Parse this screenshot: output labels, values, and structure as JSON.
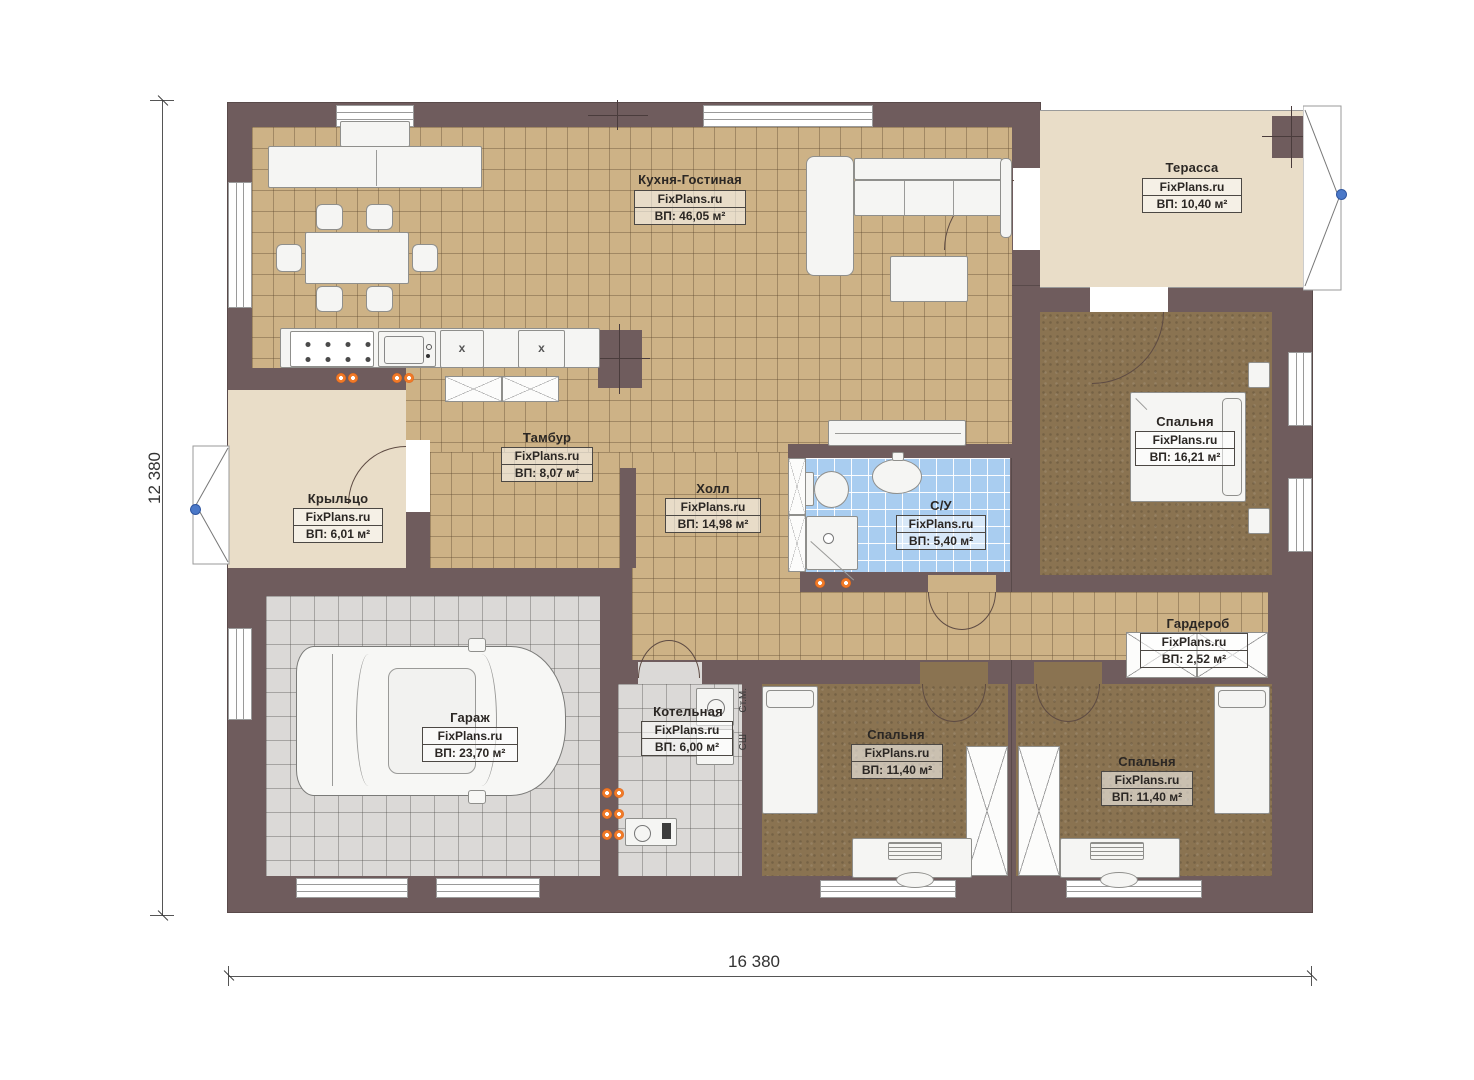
{
  "site_brand": "FixPlans.ru",
  "plan": {
    "dimensions": {
      "horizontal": "16 380",
      "vertical": "12 380"
    },
    "rooms": [
      {
        "id": "kitchen_living",
        "name": "Кухня-Гостиная",
        "brand": "FixPlans.ru",
        "area": "ВП: 46,05 м²"
      },
      {
        "id": "terrace",
        "name": "Терасса",
        "brand": "FixPlans.ru",
        "area": "ВП: 10,40 м²"
      },
      {
        "id": "bedroom_right",
        "name": "Спальня",
        "brand": "FixPlans.ru",
        "area": "ВП: 16,21 м²"
      },
      {
        "id": "tambour",
        "name": "Тамбур",
        "brand": "FixPlans.ru",
        "area": "ВП: 8,07 м²"
      },
      {
        "id": "hall",
        "name": "Холл",
        "brand": "FixPlans.ru",
        "area": "ВП: 14,98 м²"
      },
      {
        "id": "bathroom",
        "name": "С/У",
        "brand": "FixPlans.ru",
        "area": "ВП: 5,40 м²"
      },
      {
        "id": "porch",
        "name": "Крыльцо",
        "brand": "FixPlans.ru",
        "area": "ВП: 6,01 м²"
      },
      {
        "id": "wardrobe",
        "name": "Гардероб",
        "brand": "FixPlans.ru",
        "area": "ВП: 2,52 м²"
      },
      {
        "id": "garage",
        "name": "Гараж",
        "brand": "FixPlans.ru",
        "area": "ВП: 23,70 м²"
      },
      {
        "id": "boiler",
        "name": "Котельная",
        "brand": "FixPlans.ru",
        "area": "ВП: 6,00 м²"
      },
      {
        "id": "bedroom_mid",
        "name": "Спальня",
        "brand": "FixPlans.ru",
        "area": "ВП: 11,40 м²"
      },
      {
        "id": "bedroom_bottom_right",
        "name": "Спальня",
        "brand": "FixPlans.ru",
        "area": "ВП: 11,40 м²"
      }
    ],
    "annotations": {
      "washer_abbr": "Ст.М.",
      "dryer_abbr": "СШ",
      "appliance_mark": "x"
    },
    "colors": {
      "wall": "#6F5C5D",
      "tile_tan": "#CDB286",
      "wood_brown": "#8A7351",
      "bath_blue": "#A9CDF0",
      "concrete_gray": "#DBD9D7",
      "deck_cream": "#E9DDC8",
      "outlet_orange": "#F07A28",
      "anchor_blue": "#4A78C8"
    }
  }
}
